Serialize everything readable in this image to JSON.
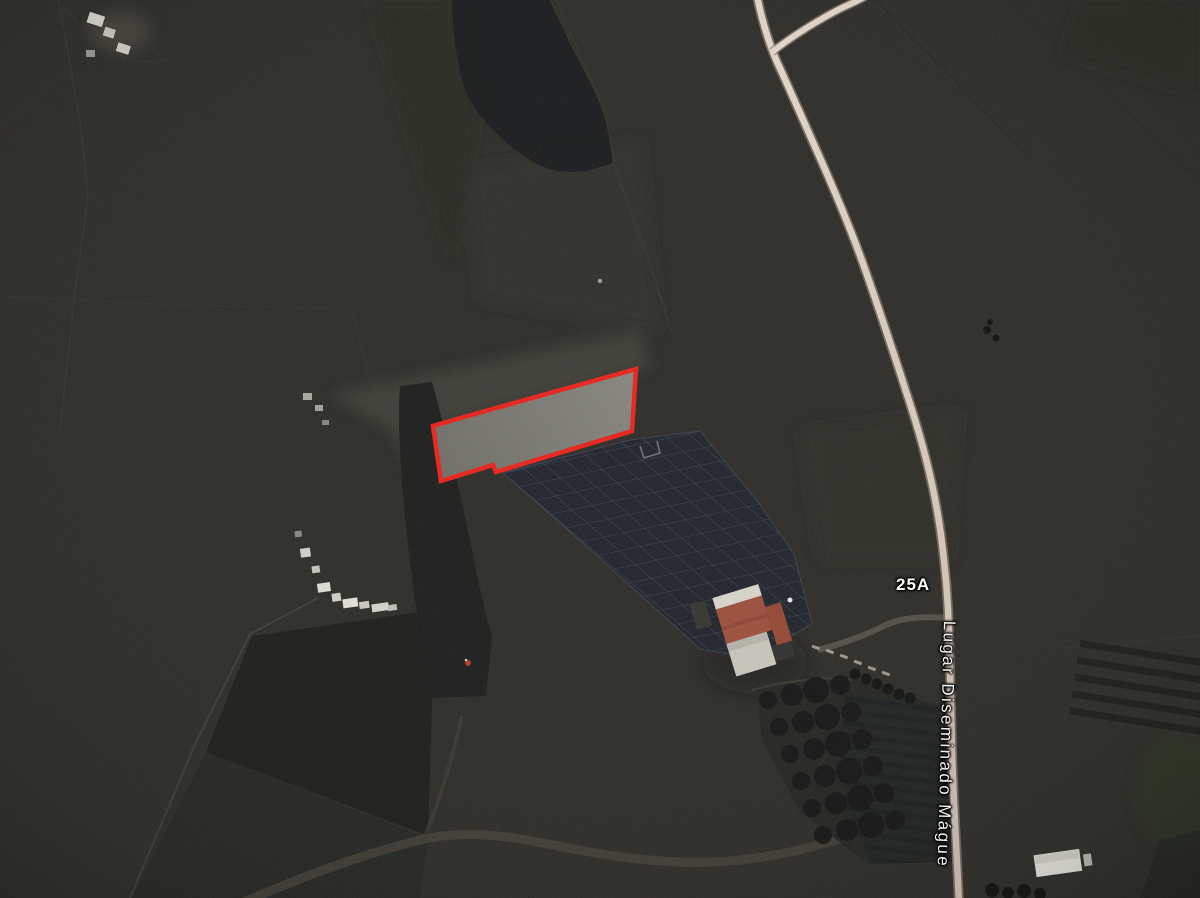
{
  "map": {
    "labels": {
      "route_marker": "25A",
      "road_name": "Lugar Diseminado Mágue"
    },
    "highlight": {
      "stroke_color": "#e9211a",
      "fill_color": "#7d7d75"
    },
    "colors": {
      "terrain_base": "#2c2b26",
      "dark_field": "#17191b",
      "road": "#d9cabc",
      "solar_array": "#1f2229",
      "roof_red": "#9d4e3b",
      "label_text": "#f2f1ed"
    }
  }
}
